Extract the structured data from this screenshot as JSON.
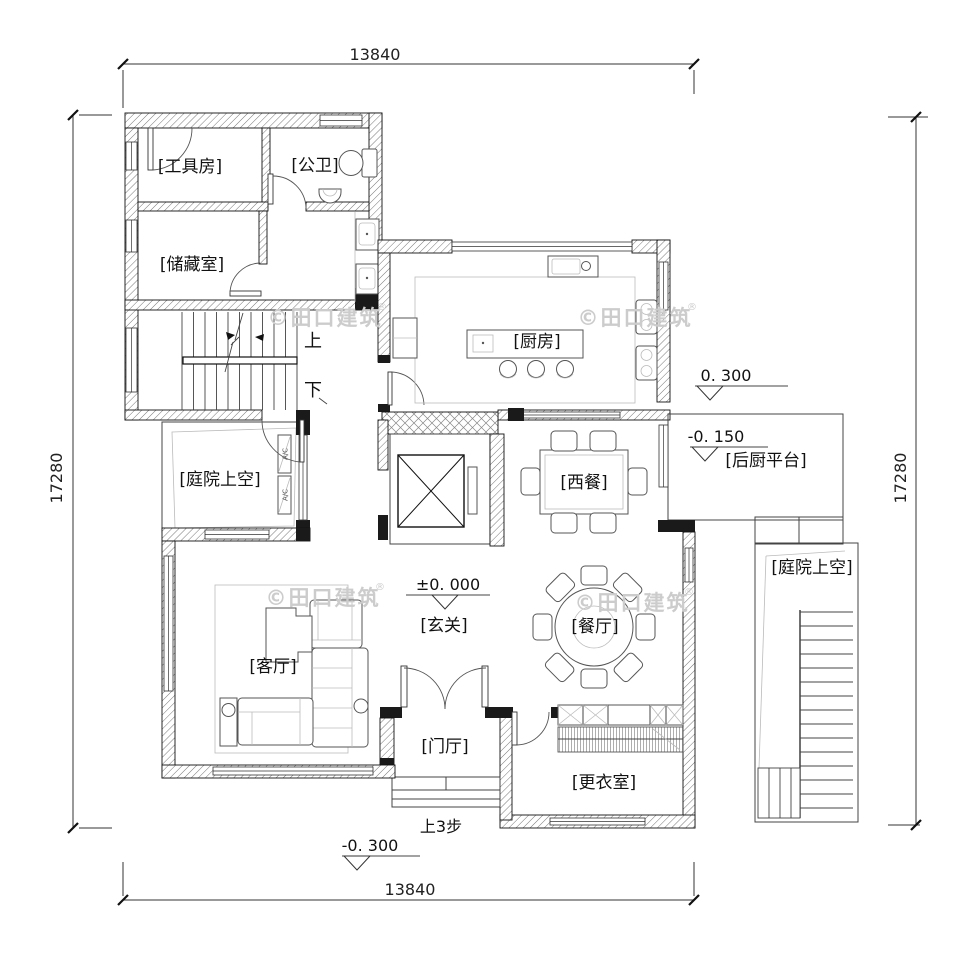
{
  "title": "residential-first-floor-plan",
  "dimensions": {
    "top": "13840",
    "bottom": "13840",
    "left": "17280",
    "right": "17280"
  },
  "rooms": {
    "tool_room": "[工具房]",
    "public_wc": "[公卫]",
    "storage": "[储藏室]",
    "kitchen": "[厨房]",
    "courtyard_left": "[庭院上空]",
    "western_dining": "[西餐]",
    "rear_kitchen_platform": "[后厨平台]",
    "courtyard_right": "[庭院上空]",
    "living_room": "[客厅]",
    "entry_hall": "[玄关]",
    "dining_room": "[餐厅]",
    "foyer": "[门厅]",
    "dressing_room": "[更衣室]"
  },
  "elevations": {
    "platform_high": "0. 300",
    "platform_low": "-0. 150",
    "ground": "±0. 000",
    "outside": "-0. 300"
  },
  "stairs": {
    "up": "上",
    "down": "下",
    "up_three_steps": "上3步"
  },
  "ac": {
    "label": "A/C"
  },
  "watermark": {
    "text": "©田口建筑",
    "reg": "®"
  },
  "colors": {
    "wall": "#1a1a1a",
    "line": "#444444",
    "watermark": "#cccccc"
  }
}
